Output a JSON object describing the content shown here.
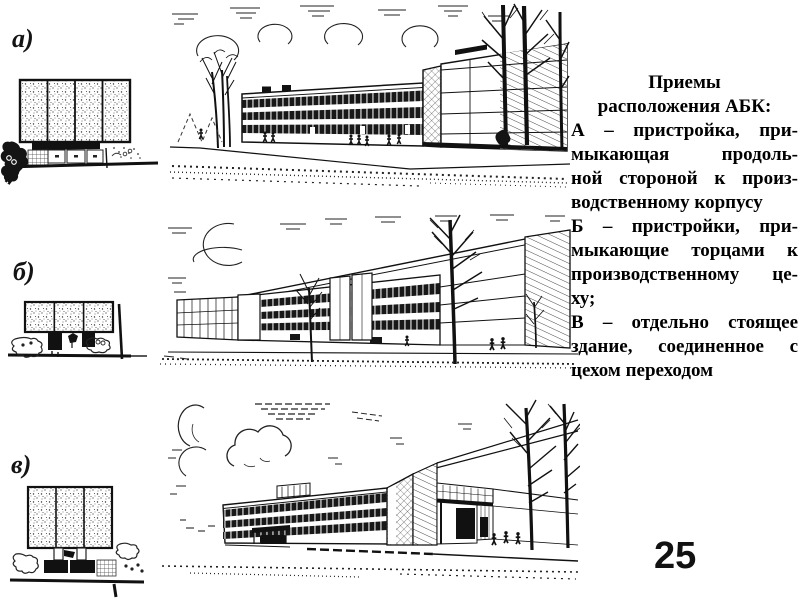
{
  "slide": {
    "background": "#ffffff",
    "ink_color": "#1a1a1a",
    "page_number": "25",
    "figure_labels": {
      "a": "а)",
      "b": "б)",
      "v": "в)"
    },
    "caption": {
      "title_lines": [
        "Приемы",
        "расположения АБК:"
      ],
      "body_lines": [
        {
          "text": "А – пристройка, при-",
          "last": false
        },
        {
          "text": "мыкающая продоль-",
          "last": false
        },
        {
          "text": "ной стороной к произ-",
          "last": false
        },
        {
          "text": "водственному корпусу",
          "last": true
        },
        {
          "text": "Б – пристройки, при-",
          "last": false
        },
        {
          "text": "мыкающие торцами к",
          "last": false
        },
        {
          "text": "производственному це-",
          "last": false
        },
        {
          "text": "ху;",
          "last": true
        },
        {
          "text": "В – отдельно стоящее",
          "last": false
        },
        {
          "text": "здание, соединенное с",
          "last": false
        },
        {
          "text": "цехом переходом",
          "last": true
        }
      ]
    }
  }
}
